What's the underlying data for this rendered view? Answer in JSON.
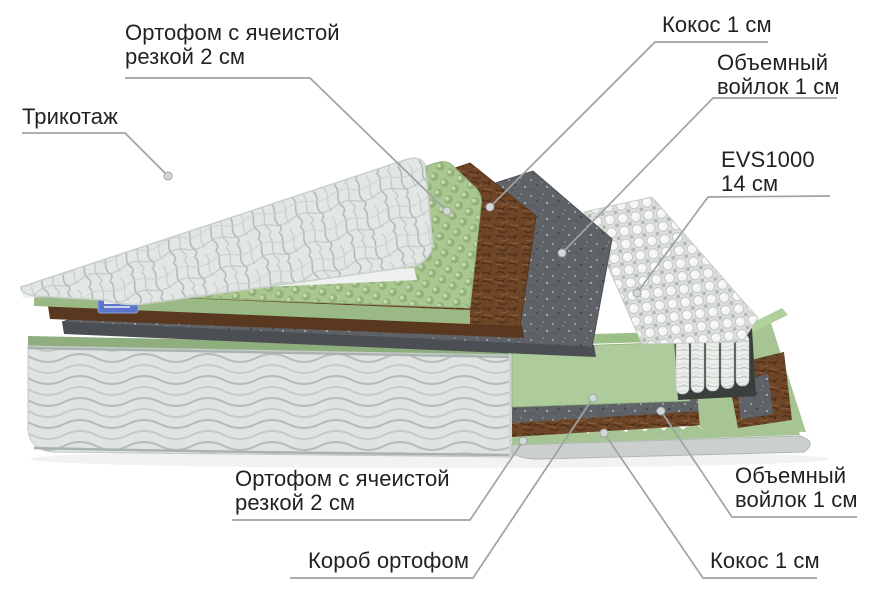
{
  "diagram_title": "mattress-layers-cutaway",
  "labels": {
    "trikotazh": {
      "text": "Трикотаж"
    },
    "ortofoam_top": {
      "line1": "Ортофом с ячеистой",
      "line2": "резкой 2 см"
    },
    "kokos_top": {
      "text": "Кокос 1 см"
    },
    "voylok_top": {
      "line1": "Объемный",
      "line2": "войлок 1 см"
    },
    "evs1000": {
      "line1": "EVS1000",
      "line2": "14 см"
    },
    "ortofoam_bottom": {
      "line1": "Ортофом с ячеистой",
      "line2": "резкой 2 см"
    },
    "korob": {
      "text": "Короб ортофом"
    },
    "voylok_bottom": {
      "line1": "Объемный",
      "line2": "войлок 1 см"
    },
    "kokos_bottom": {
      "text": "Кокос 1 см"
    }
  },
  "layer_names": [
    "Трикотаж",
    "Ортофом с ячеистой резкой 2 см",
    "Кокос 1 см",
    "Объемный войлок 1 см",
    "EVS1000 14 см",
    "Объемный войлок 1 см",
    "Кокос 1 см",
    "Ортофом с ячеистой резкой 2 см",
    "Короб ортофом"
  ],
  "colors": {
    "text": "#1f2123",
    "leader_line": "#9ea3a4",
    "foam_green": "#aac78f",
    "box_green": "#aecb9b",
    "coco_brown": "#6d4527",
    "felt_gray": "#5f6367",
    "spring_white": "#f5f6f4",
    "quilt_white": "#e2e6e4",
    "tag_blue": "#5b76c8"
  }
}
